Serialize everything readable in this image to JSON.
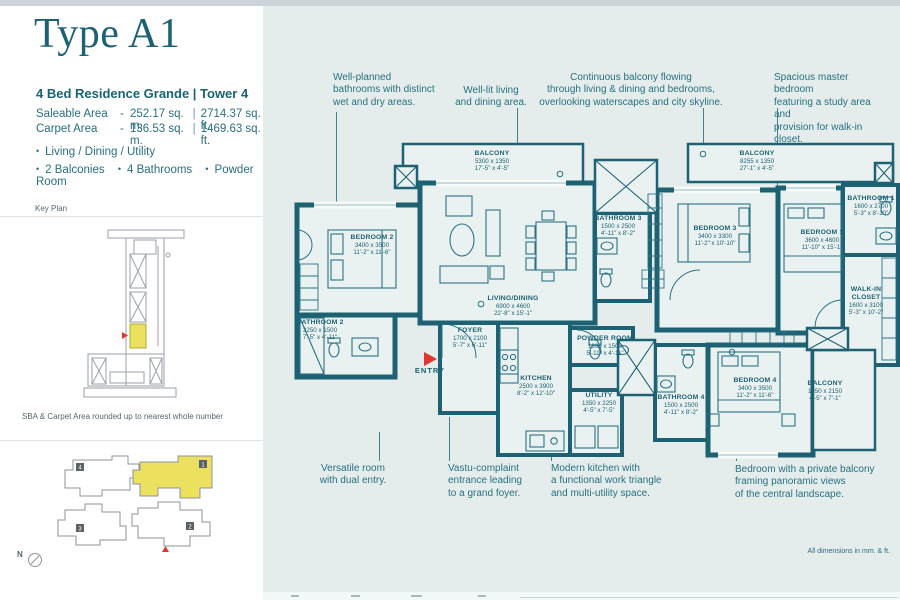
{
  "sidebar": {
    "title": "Type A1",
    "subtitle": "4 Bed Residence Grande  |  Tower 4",
    "areas": [
      {
        "label": "Saleable Area",
        "dash": "-",
        "metric": "252.17 sq. m.",
        "sep": "|",
        "imperial": "2714.37 sq. ft."
      },
      {
        "label": "Carpet Area",
        "dash": "-",
        "metric": "136.53 sq. m.",
        "sep": "|",
        "imperial": "1469.63 sq. ft."
      }
    ],
    "bullet": "•",
    "features_row1": [
      "Living / Dining / Utility"
    ],
    "features_row2": [
      "2 Balconies",
      "4 Bathrooms",
      "Powder Room"
    ],
    "key_plan_label": "Key Plan",
    "area_note": "SBA & Carpet Area rounded up to nearest whole number",
    "site_plan_blocks": [
      {
        "num": "4"
      },
      {
        "num": "1"
      },
      {
        "num": "3"
      },
      {
        "num": "2"
      }
    ],
    "compass": "N"
  },
  "annotations": {
    "top": [
      {
        "text": "Well-planned\nbathrooms with distinct\nwet and dry areas."
      },
      {
        "text": "Well-lit living\nand dining area."
      },
      {
        "text": "Continuous balcony flowing\nthrough living & dining and bedrooms,\noverlooking waterscapes and city skyline."
      },
      {
        "text": "Spacious master bedroom\nfeaturing a study area and\nprovision for walk-in closet."
      }
    ],
    "bottom": [
      {
        "text": "Versatile room\nwith dual entry."
      },
      {
        "text": "Vastu-complaint\nentrance leading\nto a grand foyer."
      },
      {
        "text": "Modern kitchen with\na functional work triangle\nand multi-utility space."
      },
      {
        "text": "Bedroom with a private balcony\nframing panoramic views\nof the central landscape."
      }
    ],
    "dimensions_note": "All dimensions in mm. & ft."
  },
  "plan": {
    "entry_label": "ENTRY",
    "rooms": [
      {
        "name": "BALCONY",
        "mm": "5300 x 1350",
        "ft": "17'-5\" x 4'-5\""
      },
      {
        "name": "BALCONY",
        "mm": "8255 x 1350",
        "ft": "27'-1\" x 4'-5\""
      },
      {
        "name": "BEDROOM 2",
        "mm": "3400 x 3500",
        "ft": "11'-2\" x 11'-6\""
      },
      {
        "name": "BATHROOM 2",
        "mm": "2250 x 1500",
        "ft": "7'-5\" x 4'-11\""
      },
      {
        "name": "LIVING/DINING",
        "mm": "6900 x 4600",
        "ft": "22'-8\" x 15'-1\""
      },
      {
        "name": "FOYER",
        "mm": "1700 x 2100",
        "ft": "5'-7\" x 6'-11\""
      },
      {
        "name": "KITCHEN",
        "mm": "2500 x 3900",
        "ft": "8'-2\" x 12'-10\""
      },
      {
        "name": "UTILITY",
        "mm": "1350 x 2250",
        "ft": "4'-5\" x 7'-5\""
      },
      {
        "name": "POWDER ROOM",
        "mm": "1800 x 1500",
        "ft": "5'-11\" x 4'-11\""
      },
      {
        "name": "BATHROOM 3",
        "mm": "1500 x 2500",
        "ft": "4'-11\" x 8'-2\""
      },
      {
        "name": "BEDROOM 3",
        "mm": "3400 x 3300",
        "ft": "11'-2\" x 10'-10\""
      },
      {
        "name": "BEDROOM 1",
        "mm": "3600 x 4600",
        "ft": "11'-10\" x 15'-1\""
      },
      {
        "name": "BATHROOM 1",
        "mm": "1600 x 2700",
        "ft": "5'-3\" x 8'-10\""
      },
      {
        "name": "WALK-IN CLOSET",
        "mm": "1600 x 3100",
        "ft": "5'-3\" x 10'-2\""
      },
      {
        "name": "BATHROOM 4",
        "mm": "1500 x 2500",
        "ft": "4'-11\" x 8'-2\""
      },
      {
        "name": "BEDROOM 4",
        "mm": "3400 x 3500",
        "ft": "11'-2\" x 11'-6\""
      },
      {
        "name": "BALCONY",
        "mm": "1350 x 2150",
        "ft": "4'-5\" x 7'-1\""
      }
    ]
  },
  "colors": {
    "wall_teal": "#1d6173",
    "text_teal": "#27707f",
    "highlight_yellow": "#ebe15e",
    "entry_red": "#e2352e",
    "plan_bg": "#e4edec"
  }
}
